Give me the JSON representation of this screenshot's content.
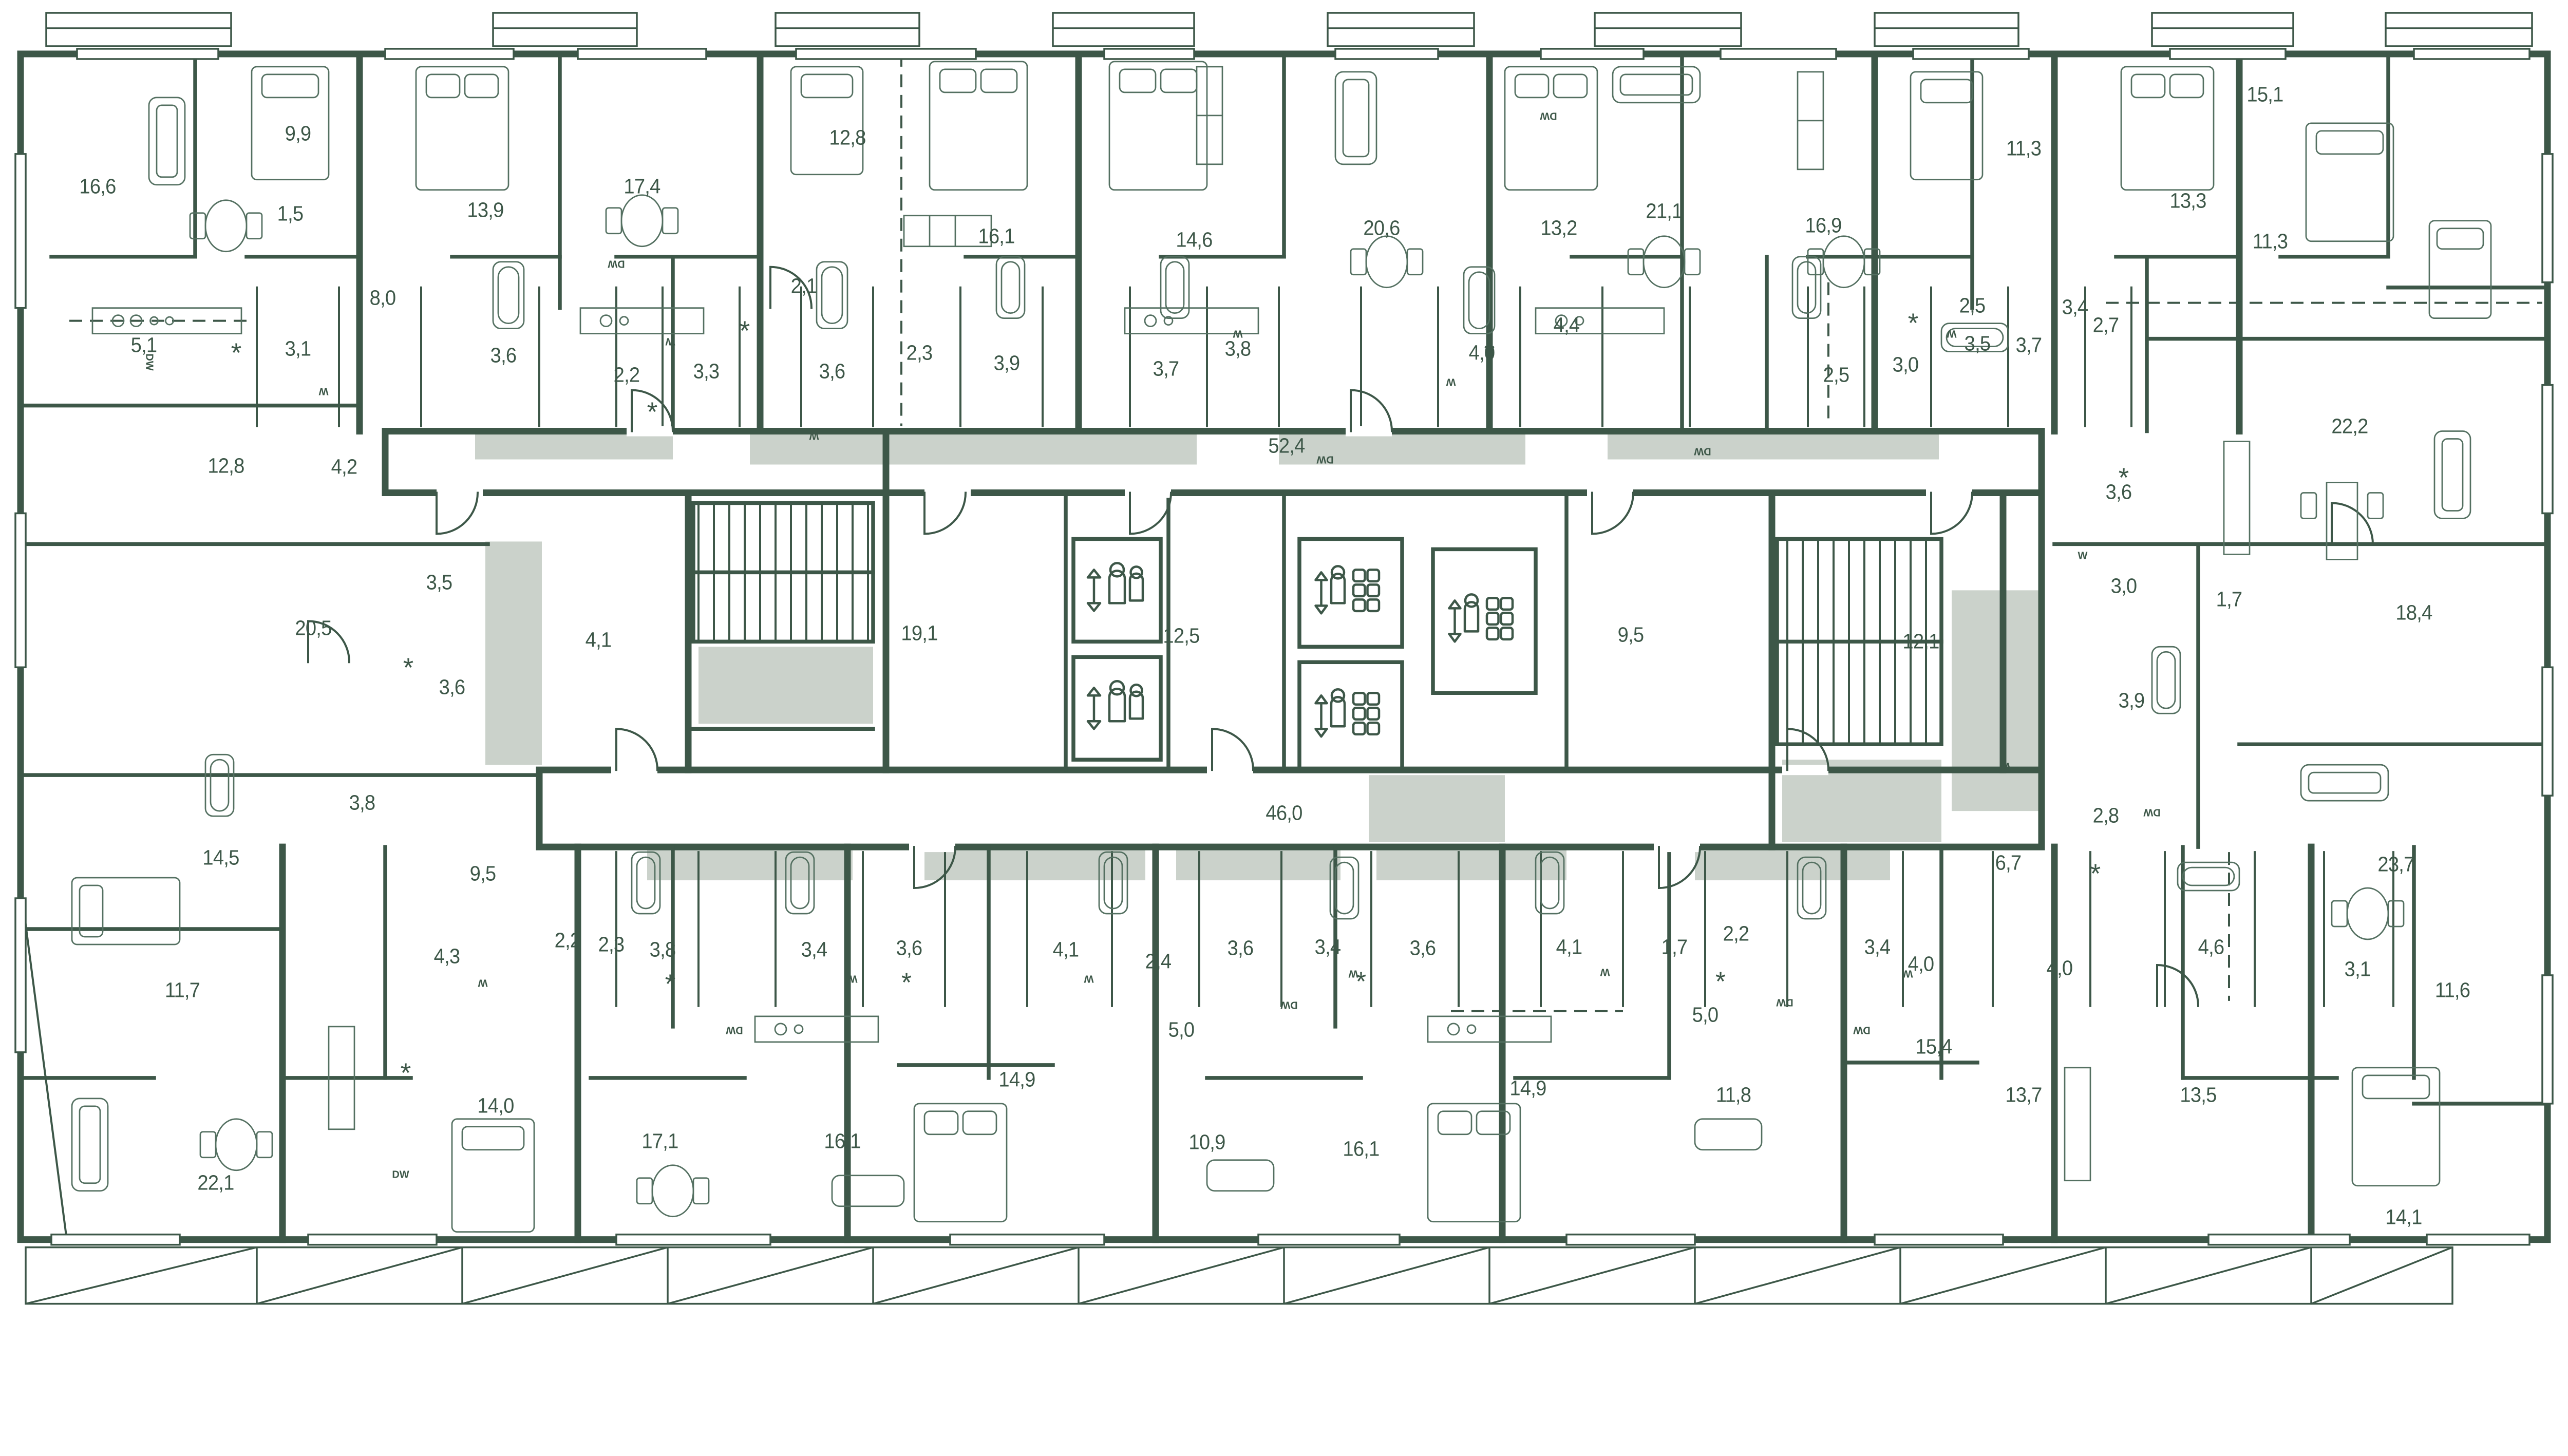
{
  "meta": {
    "type": "residential-floor-plan",
    "units_hint": "room areas in square meters, comma decimal separator"
  },
  "palette": {
    "line": "#3d5748",
    "line_soft": "#547061",
    "gray": "#cbd2cb",
    "bg": "#ffffff",
    "label": "#3d5748"
  },
  "area_labels": [
    {
      "v": "16,6",
      "x": 3.8,
      "y": 14.2
    },
    {
      "v": "9,9",
      "x": 11.6,
      "y": 10.2
    },
    {
      "v": "1,5",
      "x": 11.3,
      "y": 16.3
    },
    {
      "v": "13,9",
      "x": 18.9,
      "y": 16.0
    },
    {
      "v": "17,4",
      "x": 25.0,
      "y": 14.2
    },
    {
      "v": "12,8",
      "x": 33.0,
      "y": 10.5
    },
    {
      "v": "16,1",
      "x": 38.8,
      "y": 18.0
    },
    {
      "v": "14,6",
      "x": 46.5,
      "y": 18.3
    },
    {
      "v": "20,6",
      "x": 53.8,
      "y": 17.4
    },
    {
      "v": "13,2",
      "x": 60.7,
      "y": 17.4
    },
    {
      "v": "21,1",
      "x": 64.8,
      "y": 16.1
    },
    {
      "v": "16,9",
      "x": 71.0,
      "y": 17.2
    },
    {
      "v": "11,3",
      "x": 78.8,
      "y": 11.3
    },
    {
      "v": "13,3",
      "x": 85.2,
      "y": 15.3
    },
    {
      "v": "15,1",
      "x": 88.2,
      "y": 7.2
    },
    {
      "v": "11,3",
      "x": 88.4,
      "y": 18.4
    },
    {
      "v": "5,1",
      "x": 5.6,
      "y": 26.3
    },
    {
      "v": "3,1",
      "x": 11.6,
      "y": 26.6
    },
    {
      "v": "8,0",
      "x": 14.9,
      "y": 22.7
    },
    {
      "v": "3,6",
      "x": 19.6,
      "y": 27.1
    },
    {
      "v": "2,2",
      "x": 24.4,
      "y": 28.6
    },
    {
      "v": "3,3",
      "x": 27.5,
      "y": 28.3
    },
    {
      "v": "2,1",
      "x": 31.3,
      "y": 21.8
    },
    {
      "v": "3,6",
      "x": 32.4,
      "y": 28.3
    },
    {
      "v": "2,3",
      "x": 35.8,
      "y": 26.9
    },
    {
      "v": "3,9",
      "x": 39.2,
      "y": 27.7
    },
    {
      "v": "3,7",
      "x": 45.4,
      "y": 28.1
    },
    {
      "v": "3,8",
      "x": 48.2,
      "y": 26.6
    },
    {
      "v": "4,0",
      "x": 57.7,
      "y": 26.9
    },
    {
      "v": "4,4",
      "x": 61.0,
      "y": 24.8
    },
    {
      "v": "2,5",
      "x": 71.5,
      "y": 28.6
    },
    {
      "v": "3,0",
      "x": 74.2,
      "y": 27.8
    },
    {
      "v": "2,5",
      "x": 76.8,
      "y": 23.3
    },
    {
      "v": "3,5",
      "x": 77.0,
      "y": 26.2
    },
    {
      "v": "3,7",
      "x": 79.0,
      "y": 26.3
    },
    {
      "v": "3,4",
      "x": 80.8,
      "y": 23.4
    },
    {
      "v": "2,7",
      "x": 82.0,
      "y": 24.8
    },
    {
      "v": "22,2",
      "x": 91.5,
      "y": 32.5
    },
    {
      "v": "3,6",
      "x": 82.5,
      "y": 37.5
    },
    {
      "v": "52,4",
      "x": 50.1,
      "y": 34.0
    },
    {
      "v": "12,8",
      "x": 8.8,
      "y": 35.5
    },
    {
      "v": "4,2",
      "x": 13.4,
      "y": 35.6
    },
    {
      "v": "3,5",
      "x": 17.1,
      "y": 44.4
    },
    {
      "v": "20,5",
      "x": 12.2,
      "y": 47.9
    },
    {
      "v": "3,6",
      "x": 17.6,
      "y": 52.4
    },
    {
      "v": "4,1",
      "x": 23.3,
      "y": 48.8
    },
    {
      "v": "19,1",
      "x": 35.8,
      "y": 48.3
    },
    {
      "v": "12,5",
      "x": 46.0,
      "y": 48.5
    },
    {
      "v": "9,5",
      "x": 63.5,
      "y": 48.4
    },
    {
      "v": "12,1",
      "x": 74.8,
      "y": 48.9
    },
    {
      "v": "3,0",
      "x": 82.7,
      "y": 44.7
    },
    {
      "v": "1,7",
      "x": 86.8,
      "y": 45.7
    },
    {
      "v": "18,4",
      "x": 94.0,
      "y": 46.7
    },
    {
      "v": "3,9",
      "x": 83.0,
      "y": 53.4
    },
    {
      "v": "2,8",
      "x": 82.0,
      "y": 62.2
    },
    {
      "v": "6,7",
      "x": 78.2,
      "y": 65.8
    },
    {
      "v": "23,7",
      "x": 93.3,
      "y": 65.9
    },
    {
      "v": "14,5",
      "x": 8.6,
      "y": 65.4
    },
    {
      "v": "3,8",
      "x": 14.1,
      "y": 61.2
    },
    {
      "v": "9,5",
      "x": 18.8,
      "y": 66.6
    },
    {
      "v": "46,0",
      "x": 50.0,
      "y": 62.0
    },
    {
      "v": "11,7",
      "x": 7.1,
      "y": 75.5
    },
    {
      "v": "4,3",
      "x": 17.4,
      "y": 72.9
    },
    {
      "v": "2,2",
      "x": 22.1,
      "y": 71.7
    },
    {
      "v": "2,3",
      "x": 23.8,
      "y": 72.0
    },
    {
      "v": "3,8",
      "x": 25.8,
      "y": 72.4
    },
    {
      "v": "3,4",
      "x": 31.7,
      "y": 72.4
    },
    {
      "v": "3,6",
      "x": 35.4,
      "y": 72.3
    },
    {
      "v": "4,1",
      "x": 41.5,
      "y": 72.4
    },
    {
      "v": "2,4",
      "x": 45.1,
      "y": 73.3
    },
    {
      "v": "3,6",
      "x": 48.3,
      "y": 72.3
    },
    {
      "v": "3,4",
      "x": 51.7,
      "y": 72.2
    },
    {
      "v": "3,6",
      "x": 55.4,
      "y": 72.3
    },
    {
      "v": "4,1",
      "x": 61.1,
      "y": 72.2
    },
    {
      "v": "1,7",
      "x": 65.2,
      "y": 72.2
    },
    {
      "v": "2,2",
      "x": 67.6,
      "y": 71.2
    },
    {
      "v": "3,4",
      "x": 73.1,
      "y": 72.2
    },
    {
      "v": "4,0",
      "x": 74.8,
      "y": 73.5
    },
    {
      "v": "4,0",
      "x": 80.2,
      "y": 73.8
    },
    {
      "v": "4,6",
      "x": 86.1,
      "y": 72.2
    },
    {
      "v": "3,1",
      "x": 91.8,
      "y": 73.9
    },
    {
      "v": "11,6",
      "x": 95.5,
      "y": 75.5
    },
    {
      "v": "5,0",
      "x": 46.0,
      "y": 78.5
    },
    {
      "v": "5,0",
      "x": 66.4,
      "y": 77.4
    },
    {
      "v": "22,1",
      "x": 8.4,
      "y": 90.2
    },
    {
      "v": "14,0",
      "x": 19.3,
      "y": 84.3
    },
    {
      "v": "17,1",
      "x": 25.7,
      "y": 87.0
    },
    {
      "v": "16,1",
      "x": 32.8,
      "y": 87.0
    },
    {
      "v": "14,9",
      "x": 39.6,
      "y": 82.3
    },
    {
      "v": "10,9",
      "x": 47.0,
      "y": 87.1
    },
    {
      "v": "16,1",
      "x": 53.0,
      "y": 87.6
    },
    {
      "v": "14,9",
      "x": 59.5,
      "y": 83.0
    },
    {
      "v": "11,8",
      "x": 67.5,
      "y": 83.5
    },
    {
      "v": "15,4",
      "x": 75.3,
      "y": 79.8
    },
    {
      "v": "13,7",
      "x": 78.8,
      "y": 83.5
    },
    {
      "v": "13,5",
      "x": 85.6,
      "y": 83.5
    },
    {
      "v": "14,1",
      "x": 93.6,
      "y": 92.8
    }
  ],
  "appliance_labels": [
    {
      "t": "DW",
      "x": 24.0,
      "y": 20.1,
      "r": 180
    },
    {
      "t": "DW",
      "x": 5.8,
      "y": 27.6,
      "r": 90
    },
    {
      "t": "DW",
      "x": 60.3,
      "y": 8.8,
      "r": 180
    },
    {
      "t": "DW",
      "x": 51.6,
      "y": 35.0,
      "r": 180
    },
    {
      "t": "DW",
      "x": 66.3,
      "y": 34.4,
      "r": 180
    },
    {
      "t": "DW",
      "x": 83.8,
      "y": 61.9,
      "r": 180
    },
    {
      "t": "DW",
      "x": 15.6,
      "y": 89.6,
      "r": 0
    },
    {
      "t": "DW",
      "x": 28.6,
      "y": 78.5,
      "r": 180
    },
    {
      "t": "DW",
      "x": 50.2,
      "y": 76.6,
      "r": 180
    },
    {
      "t": "DW",
      "x": 69.5,
      "y": 76.4,
      "r": 180
    },
    {
      "t": "DW",
      "x": 72.5,
      "y": 78.5,
      "r": 180
    },
    {
      "t": "W",
      "x": 26.1,
      "y": 26.0,
      "r": 180
    },
    {
      "t": "W",
      "x": 12.6,
      "y": 29.8,
      "r": 180
    },
    {
      "t": "W",
      "x": 31.7,
      "y": 33.2,
      "r": 180
    },
    {
      "t": "W",
      "x": 48.2,
      "y": 25.4,
      "r": 180
    },
    {
      "t": "W",
      "x": 56.5,
      "y": 29.1,
      "r": 180
    },
    {
      "t": "W",
      "x": 76.0,
      "y": 25.4,
      "r": 180
    },
    {
      "t": "W",
      "x": 81.1,
      "y": 42.4,
      "r": 0
    },
    {
      "t": "W",
      "x": 78.1,
      "y": 58.4,
      "r": 180
    },
    {
      "t": "W",
      "x": 18.8,
      "y": 74.9,
      "r": 180
    },
    {
      "t": "W",
      "x": 33.2,
      "y": 74.6,
      "r": 180
    },
    {
      "t": "W",
      "x": 42.4,
      "y": 74.6,
      "r": 180
    },
    {
      "t": "W",
      "x": 52.7,
      "y": 74.2,
      "r": 180
    },
    {
      "t": "W",
      "x": 62.5,
      "y": 74.1,
      "r": 180
    },
    {
      "t": "W",
      "x": 74.3,
      "y": 74.2,
      "r": 180
    }
  ],
  "symbols": [
    {
      "t": "*",
      "x": 9.2,
      "y": 26.8
    },
    {
      "t": "*",
      "x": 25.4,
      "y": 31.3
    },
    {
      "t": "*",
      "x": 29.0,
      "y": 25.1
    },
    {
      "t": "*",
      "x": 58.0,
      "y": 26.8
    },
    {
      "t": "*",
      "x": 74.5,
      "y": 24.5
    },
    {
      "t": "*",
      "x": 82.7,
      "y": 36.3
    },
    {
      "t": "*",
      "x": 15.9,
      "y": 50.8
    },
    {
      "t": "*",
      "x": 81.6,
      "y": 66.5
    },
    {
      "t": "*",
      "x": 15.8,
      "y": 81.7
    },
    {
      "t": "*",
      "x": 26.1,
      "y": 74.9
    },
    {
      "t": "*",
      "x": 35.3,
      "y": 74.8
    },
    {
      "t": "*",
      "x": 53.0,
      "y": 74.7
    },
    {
      "t": "*",
      "x": 67.0,
      "y": 74.7
    }
  ],
  "fixtures": {
    "staircases": [
      {
        "name": "staircase",
        "x": 30.5,
        "y": 47.0
      },
      {
        "name": "staircase",
        "x": 72.4,
        "y": 49.0
      }
    ],
    "elevators": [
      {
        "name": "passenger-elevator",
        "x": 43.5,
        "y": 45.0
      },
      {
        "name": "passenger-elevator",
        "x": 43.5,
        "y": 54.0
      },
      {
        "name": "cargo-elevator",
        "x": 52.6,
        "y": 45.2
      },
      {
        "name": "cargo-elevator",
        "x": 52.6,
        "y": 54.6
      },
      {
        "name": "cargo-elevator",
        "x": 57.8,
        "y": 47.4
      }
    ],
    "corridors": [
      "52,4",
      "46,0"
    ],
    "balconies": "hatched band along bottom edge"
  }
}
